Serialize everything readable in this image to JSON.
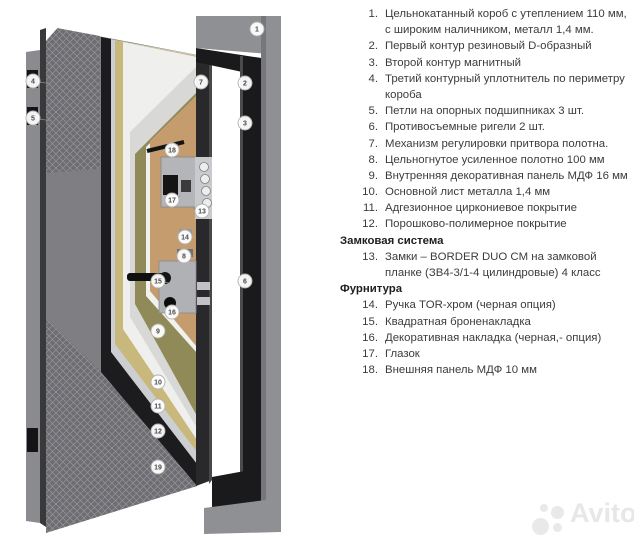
{
  "watermark": {
    "text": "Avito"
  },
  "legend": {
    "blocks": [
      {
        "type": "item",
        "n": "1.",
        "text": "Цельнокатанный короб с утеплением 110 мм, с широким наличником, металл 1,4 мм."
      },
      {
        "type": "item",
        "n": "2.",
        "text": "Первый контур резиновый D-образный"
      },
      {
        "type": "item",
        "n": "3.",
        "text": "Второй контур магнитный"
      },
      {
        "type": "item",
        "n": "4.",
        "text": "Третий контурный уплотнитель по периметру короба"
      },
      {
        "type": "item",
        "n": "5.",
        "text": "Петли на опорных подшипниках 3 шт."
      },
      {
        "type": "item",
        "n": "6.",
        "text": "Противосъемные ригели 2 шт."
      },
      {
        "type": "item",
        "n": "7.",
        "text": "Механизм регулировки притвора полотна."
      },
      {
        "type": "item",
        "n": "8.",
        "text": "Цельногнутое усиленное полотно 100 мм"
      },
      {
        "type": "item",
        "n": "9.",
        "text": "Внутренняя декоративная панель МДФ 16 мм"
      },
      {
        "type": "item",
        "n": "10.",
        "text": "Основной лист металла 1,4 мм"
      },
      {
        "type": "item",
        "n": "11.",
        "text": "Адгезионное циркониевое покрытие"
      },
      {
        "type": "item",
        "n": "12.",
        "text": "Порошково-полимерное покрытие"
      },
      {
        "type": "header",
        "text": "Замковая система"
      },
      {
        "type": "item",
        "n": "13.",
        "text": "Замки – BORDER DUO CM на замковой планке (ЗВ4-3/1-4 цилиндровые) 4 класс"
      },
      {
        "type": "header",
        "text": "Фурнитура"
      },
      {
        "type": "item",
        "n": "14.",
        "text": "Ручка TOR-хром (черная опция)"
      },
      {
        "type": "item",
        "n": "15.",
        "text": "Квадратная броненакладка"
      },
      {
        "type": "item",
        "n": "16.",
        "text": "Декоративная накладка (черная,- опция)"
      },
      {
        "type": "item",
        "n": "17.",
        "text": "Глазок"
      },
      {
        "type": "item",
        "n": "18.",
        "text": "Внешняя панель МДФ 10 мм"
      }
    ]
  },
  "diagram": {
    "colors": {
      "texture_base": "#6e6e72",
      "texture_line": "#94949a",
      "plain_face": "#7f7f83",
      "wall": "#8a8b8f",
      "edge_dark": "#39393b",
      "band_black": "#1c1c1e",
      "band_silver": "#cdced2",
      "band_tan": "#c8b87c",
      "band_white": "#efefed",
      "band_lgray": "#d8d8d6",
      "band_olive": "#8f8a57",
      "band_white2": "#f1f1ef",
      "wood": "#c59c6e",
      "lock_strip": "#29292b",
      "frame_gray": "#8f9093",
      "frame_black": "#1a1a1c",
      "hardware_silver": "#b4b5b9",
      "hardware_black": "#141414",
      "callout_fill": "#ffffff",
      "callout_stroke": "#b2b2b2",
      "callout_text": "#4a4a4a"
    },
    "shapes": [
      {
        "name": "wall-left",
        "kind": "polygon",
        "points": [
          [
            26,
            52
          ],
          [
            40,
            50
          ],
          [
            40,
            523
          ],
          [
            26,
            521
          ]
        ],
        "fill": "#8a8b8f"
      },
      {
        "name": "wall-edge-dark",
        "kind": "polygon",
        "points": [
          [
            40,
            30
          ],
          [
            46,
            28
          ],
          [
            46,
            527
          ],
          [
            40,
            523
          ]
        ],
        "fill": "#39393b"
      },
      {
        "name": "door-face-plain",
        "kind": "polygon",
        "points": [
          [
            46,
            26
          ],
          [
            197,
            55
          ],
          [
            197,
            486
          ],
          [
            46,
            532
          ]
        ],
        "fill": "#7f7f83"
      },
      {
        "name": "door-outer-panel-texture-top",
        "kind": "polygon",
        "points": [
          [
            46,
            26
          ],
          [
            100,
            36
          ],
          [
            100,
            169
          ],
          [
            46,
            173
          ]
        ],
        "fill": "texture"
      },
      {
        "name": "door-top-corner-notch",
        "kind": "polygon",
        "points": [
          [
            46,
            26
          ],
          [
            61,
            24
          ],
          [
            46,
            41
          ]
        ],
        "fill": "#ffffff"
      },
      {
        "name": "layer-powder-coating-black",
        "kind": "polygon",
        "points": [
          [
            101,
            37
          ],
          [
            197,
            55
          ],
          [
            197,
            486
          ],
          [
            101,
            372
          ]
        ],
        "fill": "#1c1c1e"
      },
      {
        "name": "layer-zirconium-silver",
        "kind": "polygon",
        "points": [
          [
            111,
            39
          ],
          [
            197,
            55
          ],
          [
            197,
            464
          ],
          [
            111,
            352
          ]
        ],
        "fill": "#cdced2"
      },
      {
        "name": "layer-metal-sheet-tan",
        "kind": "polygon",
        "points": [
          [
            115,
            40
          ],
          [
            197,
            56
          ],
          [
            197,
            452
          ],
          [
            115,
            344
          ]
        ],
        "fill": "#c8b87c"
      },
      {
        "name": "layer-inner-face-white",
        "kind": "polygon",
        "points": [
          [
            123,
            42
          ],
          [
            197,
            57
          ],
          [
            197,
            440
          ],
          [
            123,
            329
          ]
        ],
        "fill": "#efefed"
      },
      {
        "name": "layer-light-gray",
        "kind": "polygon",
        "points": [
          [
            130,
            132
          ],
          [
            197,
            66
          ],
          [
            197,
            428
          ],
          [
            130,
            317
          ]
        ],
        "fill": "#d8d8d6"
      },
      {
        "name": "layer-insulation-olive",
        "kind": "polygon",
        "points": [
          [
            135,
            154
          ],
          [
            197,
            92
          ],
          [
            197,
            416
          ],
          [
            135,
            304
          ]
        ],
        "fill": "#8f8a57"
      },
      {
        "name": "layer-white-thin",
        "kind": "polygon",
        "points": [
          [
            146,
            147
          ],
          [
            197,
            97
          ],
          [
            197,
            353
          ],
          [
            146,
            296
          ]
        ],
        "fill": "#f1f1ef"
      },
      {
        "name": "inner-mdf-panel-wood",
        "kind": "polygon",
        "points": [
          [
            150,
            141
          ],
          [
            197,
            95
          ],
          [
            197,
            347
          ],
          [
            150,
            291
          ]
        ],
        "fill": "#c59c6e"
      },
      {
        "name": "door-outer-panel-texture-bottom",
        "kind": "polygon",
        "points": [
          [
            46,
            318
          ],
          [
            101,
            372
          ],
          [
            197,
            486
          ],
          [
            46,
            533
          ]
        ],
        "fill": "texture"
      },
      {
        "name": "lock-edge-strip",
        "kind": "polygon",
        "points": [
          [
            196,
            54
          ],
          [
            212,
            57
          ],
          [
            212,
            480
          ],
          [
            196,
            486
          ]
        ],
        "fill": "#29292b"
      },
      {
        "name": "lock-edge-highlight",
        "kind": "polygon",
        "points": [
          [
            209,
            56
          ],
          [
            212,
            57
          ],
          [
            212,
            480
          ],
          [
            209,
            484
          ]
        ],
        "fill": "#48484a"
      },
      {
        "name": "peephole-tube",
        "kind": "line",
        "x1": 147,
        "y1": 151,
        "x2": 184,
        "y2": 142,
        "stroke": "#141414",
        "sw": 4
      },
      {
        "name": "lock-plate-upper",
        "kind": "rect",
        "x": 161,
        "y": 157,
        "w": 35,
        "h": 50,
        "fill": "#b4b5b9",
        "stroke": "#87878b",
        "sw": 0.8
      },
      {
        "name": "lock-body",
        "kind": "rect",
        "x": 163,
        "y": 175,
        "w": 15,
        "h": 20,
        "fill": "#141414"
      },
      {
        "name": "lock-body-secondary",
        "kind": "rect",
        "x": 181,
        "y": 180,
        "w": 10,
        "h": 12,
        "fill": "#3a3a3c"
      },
      {
        "name": "lock-plate-lower",
        "kind": "rect",
        "x": 159,
        "y": 261,
        "w": 37,
        "h": 52,
        "fill": "#b0b1b5",
        "stroke": "#8a8a8e",
        "sw": 0.8
      },
      {
        "name": "door-handle-bar",
        "kind": "rect",
        "x": 127,
        "y": 273,
        "w": 38,
        "h": 8,
        "rx": 3,
        "fill": "#101010"
      },
      {
        "name": "door-handle-base",
        "kind": "circle",
        "cx": 165,
        "cy": 278,
        "r": 6,
        "fill": "#161616"
      },
      {
        "name": "cylinder-knob",
        "kind": "circle",
        "cx": 170,
        "cy": 303,
        "r": 6,
        "fill": "#0c0c0c"
      },
      {
        "name": "rigel-plate",
        "kind": "rect",
        "x": 195,
        "y": 157,
        "w": 17,
        "h": 62,
        "fill": "#c9cacd"
      },
      {
        "name": "rigel-bolt-1",
        "kind": "circle",
        "cx": 204,
        "cy": 167,
        "r": 4.5,
        "fill": "#ededee",
        "stroke": "#808080",
        "sw": 0.8
      },
      {
        "name": "rigel-bolt-2",
        "kind": "circle",
        "cx": 205,
        "cy": 179,
        "r": 4.5,
        "fill": "#ededee",
        "stroke": "#808080",
        "sw": 0.8
      },
      {
        "name": "rigel-bolt-3",
        "kind": "circle",
        "cx": 206,
        "cy": 191,
        "r": 4.5,
        "fill": "#ededee",
        "stroke": "#808080",
        "sw": 0.8
      },
      {
        "name": "rigel-bolt-4",
        "kind": "circle",
        "cx": 207,
        "cy": 203,
        "r": 4.5,
        "fill": "#ededee",
        "stroke": "#808080",
        "sw": 0.8
      },
      {
        "name": "latch-bolt-1",
        "kind": "rect",
        "x": 197,
        "y": 282,
        "w": 13,
        "h": 8,
        "fill": "#c2c2c6"
      },
      {
        "name": "latch-bolt-2",
        "kind": "rect",
        "x": 197,
        "y": 297,
        "w": 13,
        "h": 8,
        "fill": "#c2c2c6"
      },
      {
        "name": "adjuster-bracket",
        "kind": "rect",
        "x": 179,
        "y": 229,
        "w": 13,
        "h": 10,
        "fill": "#9a9a9e"
      },
      {
        "name": "leaf-edge-bracket",
        "kind": "rect",
        "x": 177,
        "y": 249,
        "w": 16,
        "h": 8,
        "fill": "#717175"
      },
      {
        "name": "hinge-top",
        "kind": "rect",
        "x": 27,
        "y": 70,
        "w": 11,
        "h": 18,
        "fill": "#141416"
      },
      {
        "name": "hinge-middle",
        "kind": "rect",
        "x": 27,
        "y": 107,
        "w": 11,
        "h": 18,
        "fill": "#141416"
      },
      {
        "name": "hinge-bottom",
        "kind": "rect",
        "x": 27,
        "y": 428,
        "w": 11,
        "h": 24,
        "fill": "#141416"
      },
      {
        "name": "frame-top-beam",
        "kind": "polygon",
        "points": [
          [
            196,
            16
          ],
          [
            281,
            16
          ],
          [
            281,
            55
          ],
          [
            196,
            48
          ]
        ],
        "fill": "#8f9093"
      },
      {
        "name": "frame-right-column",
        "kind": "polygon",
        "points": [
          [
            261,
            16
          ],
          [
            281,
            16
          ],
          [
            281,
            532
          ],
          [
            261,
            529
          ]
        ],
        "fill": "#8f9093"
      },
      {
        "name": "frame-right-shade",
        "kind": "polygon",
        "points": [
          [
            261,
            16
          ],
          [
            266,
            16
          ],
          [
            266,
            530
          ],
          [
            261,
            529
          ]
        ],
        "fill": "#77777b"
      },
      {
        "name": "frame-black-top-bar",
        "kind": "polygon",
        "points": [
          [
            196,
            48
          ],
          [
            261,
            58
          ],
          [
            261,
            76
          ],
          [
            196,
            62
          ]
        ],
        "fill": "#1a1a1c"
      },
      {
        "name": "frame-black-right-bar",
        "kind": "polygon",
        "points": [
          [
            240,
            56
          ],
          [
            261,
            58
          ],
          [
            261,
            512
          ],
          [
            240,
            509
          ]
        ],
        "fill": "#1a1a1c"
      },
      {
        "name": "frame-black-right-highlight",
        "kind": "polygon",
        "points": [
          [
            240,
            56
          ],
          [
            243,
            56
          ],
          [
            243,
            510
          ],
          [
            240,
            509
          ]
        ],
        "fill": "#4a4a4c"
      },
      {
        "name": "threshold-black",
        "kind": "polygon",
        "points": [
          [
            212,
            477
          ],
          [
            261,
            468
          ],
          [
            261,
            512
          ],
          [
            212,
            514
          ]
        ],
        "fill": "#1a1a1c"
      },
      {
        "name": "floor-gray",
        "kind": "polygon",
        "points": [
          [
            204,
            508
          ],
          [
            281,
            498
          ],
          [
            281,
            532
          ],
          [
            204,
            534
          ]
        ],
        "fill": "#8f9093"
      }
    ],
    "callouts": [
      {
        "n": "1",
        "x": 257,
        "y": 29
      },
      {
        "n": "2",
        "x": 245,
        "y": 83
      },
      {
        "n": "3",
        "x": 245,
        "y": 123
      },
      {
        "n": "4",
        "x": 33,
        "y": 81,
        "lx": 52,
        "ly": 84
      },
      {
        "n": "5",
        "x": 33,
        "y": 118,
        "lx": 52,
        "ly": 121
      },
      {
        "n": "6",
        "x": 245,
        "y": 281
      },
      {
        "n": "7",
        "x": 201,
        "y": 82
      },
      {
        "n": "18",
        "x": 172,
        "y": 150,
        "lx": 178,
        "ly": 144
      },
      {
        "n": "17",
        "x": 172,
        "y": 200,
        "lx": 180,
        "ly": 196
      },
      {
        "n": "13",
        "x": 202,
        "y": 211,
        "lx": 193,
        "ly": 208
      },
      {
        "n": "14",
        "x": 185,
        "y": 237,
        "lx": 193,
        "ly": 240
      },
      {
        "n": "8",
        "x": 184,
        "y": 256
      },
      {
        "n": "15",
        "x": 158,
        "y": 281,
        "lx": 170,
        "ly": 283
      },
      {
        "n": "16",
        "x": 172,
        "y": 312,
        "lx": 171,
        "ly": 305
      },
      {
        "n": "9",
        "x": 158,
        "y": 331
      },
      {
        "n": "10",
        "x": 158,
        "y": 382
      },
      {
        "n": "11",
        "x": 158,
        "y": 406
      },
      {
        "n": "12",
        "x": 158,
        "y": 431
      },
      {
        "n": "19",
        "x": 158,
        "y": 467
      }
    ]
  }
}
